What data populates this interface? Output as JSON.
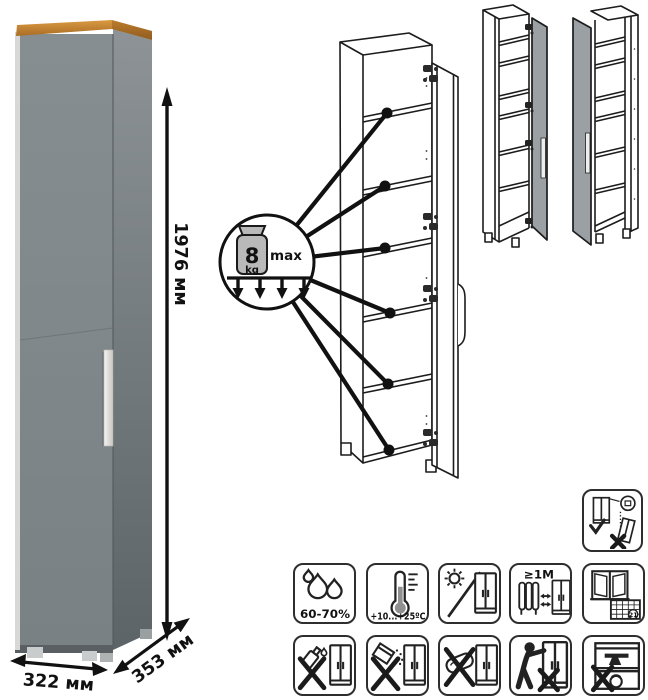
{
  "dimensions": {
    "height": "1976 мм",
    "width": "322 мм",
    "depth": "353 мм"
  },
  "load_callout": {
    "value": "8",
    "unit": "kg",
    "max_label": "max"
  },
  "care": {
    "humidity": "60-70%",
    "temperature": "+10...+25ºC",
    "min_distance": "≥1М",
    "calendar_day": "21"
  },
  "icons": {
    "standalone": "anchor-check-icon",
    "row1": [
      "humidity-drops-icon",
      "thermometer-icon",
      "no-direct-sun-icon",
      "distance-from-heat-icon",
      "ventilation-calendar-icon"
    ],
    "row2": [
      "no-solvent-icon",
      "no-abrasive-icon",
      "no-wet-sponge-icon",
      "no-dragging-icon",
      "no-overload-icon"
    ]
  },
  "colors": {
    "door_gray": "#7d858a",
    "side_gray": "#6a7276",
    "wood_trim": "#c98733",
    "variant_door_gray": "#9aa0a4",
    "line": "#1a1a1a"
  }
}
